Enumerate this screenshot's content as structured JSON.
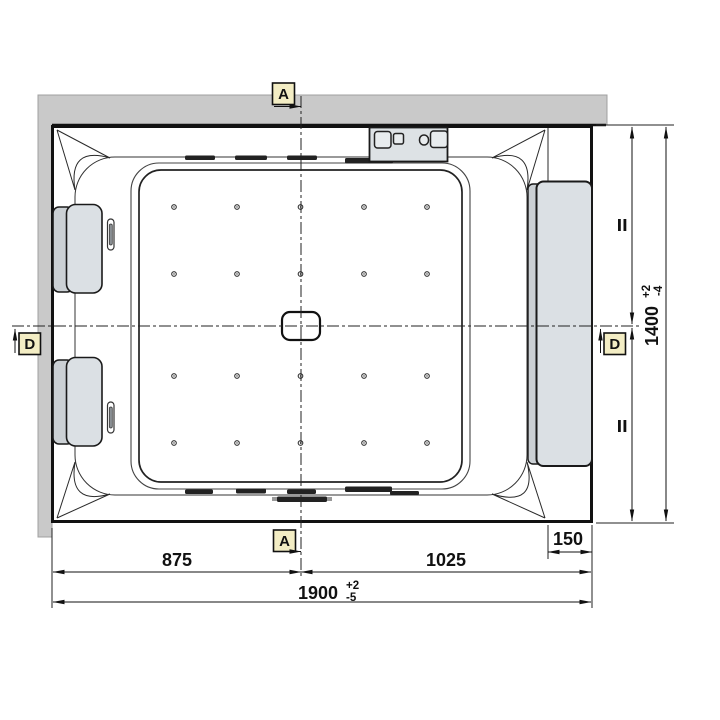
{
  "section_labels": {
    "top": "A",
    "bottom": "A",
    "left": "D",
    "right": "D"
  },
  "dimensions": {
    "left_to_center": "875",
    "center_to_right": "1025",
    "overall_width": {
      "value": "1900",
      "plus": "+2",
      "minus": "-5"
    },
    "shelf_width": "150",
    "overall_depth": {
      "value": "1400",
      "plus": "+2",
      "minus": "-4"
    }
  },
  "features": {
    "jet_rows": 4,
    "jet_columns": 5,
    "headrests": 2,
    "control_panel_buttons": 4
  },
  "colors": {
    "wall": "#c9c9c9",
    "fixture_fill": "#dbe0e4",
    "fixture_bevel": "#cbd0d4",
    "label_background": "#f3edc4",
    "line": "#1a1a1a"
  }
}
